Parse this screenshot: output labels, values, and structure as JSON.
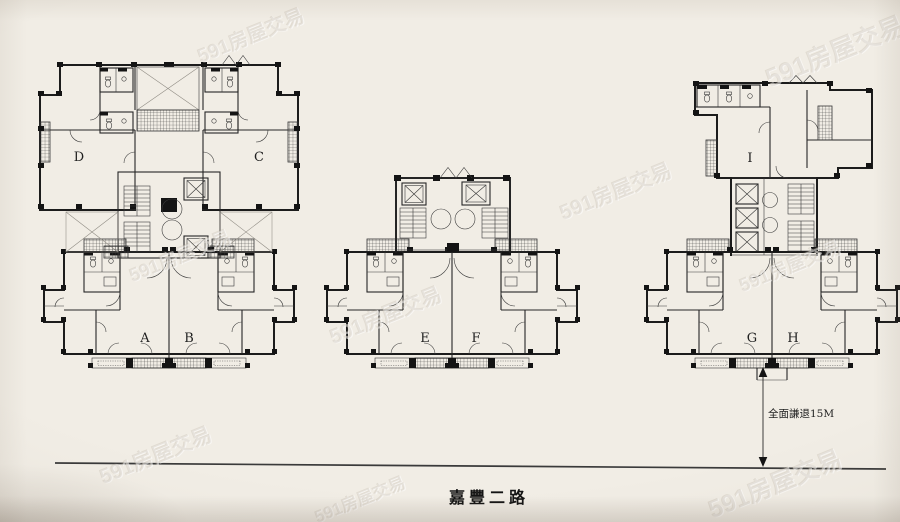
{
  "photo": {
    "paper_color": "#f1ede5",
    "ink_color": "#1c1c1c"
  },
  "watermark": {
    "text": "591房屋交易"
  },
  "plan": {
    "road_name": "嘉豐二路",
    "setback_label": "全面謙退15M",
    "buildings": [
      {
        "name": "building-left",
        "unit_labels": [
          "D",
          "C",
          "A",
          "B"
        ]
      },
      {
        "name": "building-middle",
        "unit_labels": [
          "E",
          "F"
        ]
      },
      {
        "name": "building-right",
        "unit_labels": [
          "I",
          "G",
          "H"
        ]
      }
    ]
  }
}
